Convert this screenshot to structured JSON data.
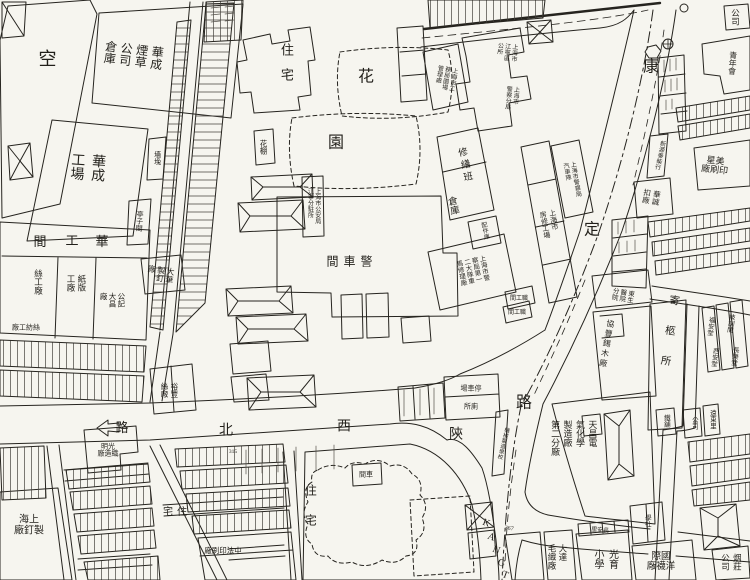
{
  "map": {
    "streets": {
      "horizontal_road": "陝西北路",
      "vertical_road": "康定路",
      "romanized": "KANGT",
      "ink_color": "#26241f",
      "paper_color": "#f6f5ef"
    },
    "chars": [
      {
        "id": "st-kang",
        "c": "康",
        "x": 651,
        "y": 68,
        "fs": 16
      },
      {
        "id": "st-ding",
        "c": "定",
        "x": 592,
        "y": 231,
        "fs": 16
      },
      {
        "id": "st-lu-kangding",
        "c": "路",
        "x": 524,
        "y": 404,
        "fs": 16
      },
      {
        "id": "st-shan",
        "c": "陝",
        "x": 456,
        "y": 436,
        "fs": 14
      },
      {
        "id": "st-xi",
        "c": "西",
        "x": 344,
        "y": 428,
        "fs": 14
      },
      {
        "id": "st-bei",
        "c": "北",
        "x": 226,
        "y": 432,
        "fs": 14
      },
      {
        "id": "st-lu-arrow",
        "c": "路",
        "x": 122,
        "y": 428,
        "fs": 13
      },
      {
        "id": "garden-hua",
        "c": "花",
        "x": 366,
        "y": 78,
        "fs": 16
      },
      {
        "id": "garden-yuan",
        "c": "園",
        "x": 336,
        "y": 144,
        "fs": 16
      },
      {
        "id": "huagongjian-1",
        "c": "華",
        "x": 102,
        "y": 242,
        "fs": 13
      },
      {
        "id": "huagongjian-2",
        "c": "工",
        "x": 72,
        "y": 241,
        "fs": 13
      },
      {
        "id": "huagongjian-3",
        "c": "間",
        "x": 40,
        "y": 242,
        "fs": 13
      },
      {
        "id": "rom-k",
        "c": "K",
        "x": 486,
        "y": 524,
        "fs": 10,
        "rot": 20
      },
      {
        "id": "rom-a",
        "c": "A",
        "x": 491,
        "y": 538,
        "fs": 10,
        "rot": 20
      },
      {
        "id": "rom-n",
        "c": "N",
        "x": 496,
        "y": 551,
        "fs": 10,
        "rot": 20
      },
      {
        "id": "rom-g",
        "c": "G",
        "x": 501,
        "y": 564,
        "fs": 10,
        "rot": 20
      },
      {
        "id": "rom-t",
        "c": "T",
        "x": 505,
        "y": 576,
        "fs": 10,
        "rot": 20
      }
    ],
    "labels": [
      {
        "id": "vacant-lot",
        "mode": "v",
        "t": "空",
        "x": 46,
        "y": 58,
        "fs": 18
      },
      {
        "id": "huacheng-tobacco-warehouse",
        "mode": "vcols",
        "cols": [
          "華成",
          "煙草",
          "公司",
          "倉庫"
        ],
        "x": 133,
        "y": 55,
        "fs": 12,
        "rot": 7,
        "gap": 3
      },
      {
        "id": "huacheng-works",
        "mode": "vcols",
        "cols": [
          "華成",
          "工場"
        ],
        "x": 86,
        "y": 167,
        "fs": 14,
        "rot": 4,
        "gap": 6
      },
      {
        "id": "qiangtu",
        "mode": "v",
        "t": "墻堍",
        "x": 157,
        "y": 158,
        "fs": 7
      },
      {
        "id": "tingzijian",
        "mode": "v",
        "t": "亭子間",
        "x": 139,
        "y": 221,
        "fs": 7,
        "rot": 4
      },
      {
        "id": "silk-works",
        "mode": "v",
        "t": "絲工廠",
        "x": 38,
        "y": 282,
        "fs": 8.5
      },
      {
        "id": "paperboard-works",
        "mode": "vcols",
        "cols": [
          "紙版",
          "工廠"
        ],
        "x": 76,
        "y": 283,
        "fs": 8.5,
        "gap": 2
      },
      {
        "id": "gongji-dachang",
        "mode": "vcols",
        "cols": [
          "公記",
          "大昌",
          "廠"
        ],
        "x": 112,
        "y": 300,
        "fs": 7.5,
        "gap": 1
      },
      {
        "id": "silk-spinning",
        "mode": "hrtl",
        "lines": [
          "絲紡工廠"
        ],
        "x": 26,
        "y": 328,
        "fs": 7
      },
      {
        "id": "dahua-nail-factory",
        "mode": "vcols",
        "cols": [
          "大華",
          "製釘",
          "廠"
        ],
        "x": 160,
        "y": 274,
        "fs": 8,
        "rot": 8,
        "gap": 1
      },
      {
        "id": "residence-north",
        "mode": "v",
        "t": "住宅",
        "x": 286,
        "y": 68,
        "fs": 13,
        "ls": 12
      },
      {
        "id": "flower-shed",
        "mode": "v",
        "t": "花棚",
        "x": 263,
        "y": 147,
        "fs": 7.5
      },
      {
        "id": "police-substation",
        "mode": "vcols",
        "cols": [
          "上海市公安局",
          "江寧分駐所"
        ],
        "x": 313,
        "y": 206,
        "fs": 6,
        "gap": 1
      },
      {
        "id": "police-garage",
        "mode": "hrtl",
        "lines": [
          "警車間"
        ],
        "x": 352,
        "y": 262,
        "fs": 12,
        "ls": 5
      },
      {
        "id": "repair-team",
        "mode": "v",
        "t": "修繕班",
        "x": 463,
        "y": 166,
        "fs": 9.5,
        "rot": -12,
        "ls": 3
      },
      {
        "id": "warehouse",
        "mode": "v",
        "t": "倉庫",
        "x": 451,
        "y": 206,
        "fs": 9.5,
        "rot": -12
      },
      {
        "id": "parts-store",
        "mode": "v",
        "t": "配件庫",
        "x": 484,
        "y": 231,
        "fs": 6,
        "rot": -12
      },
      {
        "id": "police-vehicle-repair",
        "mode": "vcols",
        "cols": [
          "上海市警",
          "察局第一",
          "二大隊車",
          "馬修理廠"
        ],
        "x": 471,
        "y": 271,
        "fs": 6.5,
        "rot": -12,
        "gap": 1
      },
      {
        "id": "housing-repair-works",
        "mode": "vcols",
        "cols": [
          "上海市",
          "房修工場"
        ],
        "x": 549,
        "y": 224,
        "fs": 7,
        "rot": -10,
        "gap": 2
      },
      {
        "id": "police-motor-team",
        "mode": "vcols",
        "cols": [
          "上海市警察局",
          "汽車隊"
        ],
        "x": 571,
        "y": 180,
        "fs": 6,
        "rot": -10,
        "gap": 1
      },
      {
        "id": "staff-room-1",
        "mode": "hrtl",
        "lines": [
          "職工間"
        ],
        "x": 519,
        "y": 299,
        "fs": 6
      },
      {
        "id": "staff-room-2",
        "mode": "hrtl",
        "lines": [
          "職工間"
        ],
        "x": 517,
        "y": 313,
        "fs": 6
      },
      {
        "id": "parks-admin",
        "mode": "vcols",
        "cols": [
          "上海市工",
          "務局園場",
          "管理處"
        ],
        "x": 445,
        "y": 78,
        "fs": 6,
        "rot": 10,
        "gap": 1
      },
      {
        "id": "jiangning-district-office",
        "mode": "vcols",
        "cols": [
          "上海市",
          "江寧區",
          "公所"
        ],
        "x": 506,
        "y": 52,
        "fs": 6,
        "rot": 5,
        "gap": 1
      },
      {
        "id": "police-branch",
        "mode": "vcols",
        "cols": [
          "上海市",
          "警察分局"
        ],
        "x": 511,
        "y": 98,
        "fs": 6,
        "rot": 5,
        "gap": 1
      },
      {
        "id": "parking-ground",
        "mode": "hrtl",
        "lines": [
          "停車場"
        ],
        "x": 471,
        "y": 389,
        "fs": 7
      },
      {
        "id": "toilet",
        "mode": "hrtl",
        "lines": [
          "廁所"
        ],
        "x": 471,
        "y": 407,
        "fs": 7
      },
      {
        "id": "garage-box",
        "mode": "hrtl",
        "lines": [
          "車間"
        ],
        "x": 366,
        "y": 475,
        "fs": 7
      },
      {
        "id": "plot-315",
        "mode": "h",
        "t": "315",
        "x": 233,
        "y": 453,
        "fs": 5.5
      },
      {
        "id": "plot-367",
        "mode": "h",
        "t": "367",
        "x": 509,
        "y": 529,
        "fs": 6,
        "rot": 10
      },
      {
        "id": "changan-li",
        "mode": "hrtl",
        "lines": [
          "長安里"
        ],
        "x": 600,
        "y": 531,
        "fs": 6,
        "rot": 6
      },
      {
        "id": "residence-blob",
        "mode": "v",
        "t": "住宅",
        "x": 310,
        "y": 514,
        "fs": 12,
        "ls": 18
      },
      {
        "id": "residence-southwest",
        "mode": "hrtl",
        "lines": [
          "住宅"
        ],
        "x": 177,
        "y": 513,
        "fs": 10,
        "ls": 4
      },
      {
        "id": "shanghai-nail-factory",
        "mode": "hrtl",
        "lines": [
          "上海",
          "製釘廠"
        ],
        "x": 29,
        "y": 526,
        "fs": 10
      },
      {
        "id": "guangming-weaving",
        "mode": "hrtl",
        "lines": [
          "光明",
          "織造廠"
        ],
        "x": 108,
        "y": 451,
        "fs": 7
      },
      {
        "id": "zhongfa-printing",
        "mode": "hrtl",
        "lines": [
          "中法印刷廠"
        ],
        "x": 223,
        "y": 551,
        "fs": 7.5
      },
      {
        "id": "yufeng-silk",
        "mode": "vcols",
        "cols": [
          "裕豐",
          "絲廠"
        ],
        "x": 169,
        "y": 390,
        "fs": 7.5,
        "gap": 2
      },
      {
        "id": "dada-wool-mill",
        "mode": "vcols",
        "cols": [
          "大達",
          "毛織廠"
        ],
        "x": 557,
        "y": 557,
        "fs": 8.5,
        "gap": 2
      },
      {
        "id": "guangyu-primary-school",
        "mode": "vcols",
        "cols": [
          "光育",
          "小學"
        ],
        "x": 604,
        "y": 559,
        "fs": 10,
        "gap": 4
      },
      {
        "id": "international-hosiery",
        "mode": "hrtl",
        "lines": [
          "國際",
          "洋襪廠"
        ],
        "x": 661,
        "y": 563,
        "fs": 9.5
      },
      {
        "id": "study-society",
        "mode": "v",
        "t": "學社",
        "x": 646,
        "y": 521,
        "fs": 6.5
      },
      {
        "id": "tobacco-shop-co",
        "mode": "vcols",
        "cols": [
          "烟莊",
          "公司"
        ],
        "x": 731,
        "y": 562,
        "fs": 8.5,
        "gap": 3
      },
      {
        "id": "iron-shop",
        "mode": "v",
        "t": "鐵舖",
        "x": 665,
        "y": 421,
        "fs": 6.5
      },
      {
        "id": "company-small",
        "mode": "v",
        "t": "公司",
        "x": 693,
        "y": 423,
        "fs": 6.5
      },
      {
        "id": "yuandong-li",
        "mode": "v",
        "t": "遠東里",
        "x": 711,
        "y": 419,
        "fs": 6.5
      },
      {
        "id": "tianchang-electrochemical",
        "mode": "vcols",
        "cols": [
          "天昌電",
          "氣化學",
          "製造廠",
          "第二分廠"
        ],
        "x": 573,
        "y": 438,
        "fs": 9,
        "gap": 3
      },
      {
        "id": "machinery-school",
        "mode": "v",
        "t": "機械製造學校",
        "x": 502,
        "y": 443,
        "fs": 5.5,
        "rot": 14
      },
      {
        "id": "xiefeng-tin-timber",
        "mode": "v",
        "t": "協豐錫木廠",
        "x": 606,
        "y": 344,
        "fs": 8,
        "rot": 10,
        "ls": 2
      },
      {
        "id": "dongsheng-hospital-branch",
        "mode": "vcols",
        "cols": [
          "東生",
          "醫院",
          "分院"
        ],
        "x": 621,
        "y": 295,
        "fs": 6.5,
        "rot": 10,
        "gap": 1
      },
      {
        "id": "coffin-repository",
        "mode": "v",
        "t": "寄柩所",
        "x": 668,
        "y": 340,
        "fs": 10.5,
        "rot": 8,
        "ls": 20
      },
      {
        "id": "fuan-tang",
        "mode": "v",
        "t": "福安堂",
        "x": 709,
        "y": 326,
        "fs": 6.5,
        "rot": 8
      },
      {
        "id": "xian-tang",
        "mode": "v",
        "t": "西安堂",
        "x": 713,
        "y": 357,
        "fs": 6.5,
        "rot": 8
      },
      {
        "id": "jixun-jian",
        "mode": "v",
        "t": "技訓間",
        "x": 729,
        "y": 323,
        "fs": 6.5,
        "rot": 8
      },
      {
        "id": "changle-tang",
        "mode": "v",
        "t": "長樂堂",
        "x": 733,
        "y": 356,
        "fs": 6.5,
        "rot": 8
      },
      {
        "id": "huacheng-button-factory",
        "mode": "vcols",
        "cols": [
          "華誠",
          "扣廠"
        ],
        "x": 651,
        "y": 197,
        "fs": 7.5,
        "rot": 10,
        "gap": 2
      },
      {
        "id": "meixing-printing",
        "mode": "hrtl",
        "lines": [
          "美星",
          "印刷廠"
        ],
        "x": 715,
        "y": 166,
        "fs": 9,
        "rot": 6
      },
      {
        "id": "xinyuantai-store",
        "mode": "v",
        "t": "新源泰柴行",
        "x": 659,
        "y": 155,
        "fs": 6,
        "rot": 12
      },
      {
        "id": "company-topright",
        "mode": "v",
        "t": "公司",
        "x": 735,
        "y": 17,
        "fs": 8.5
      },
      {
        "id": "youth-association",
        "mode": "v",
        "t": "青年會",
        "x": 732,
        "y": 63,
        "fs": 8,
        "rot": 4
      }
    ]
  }
}
